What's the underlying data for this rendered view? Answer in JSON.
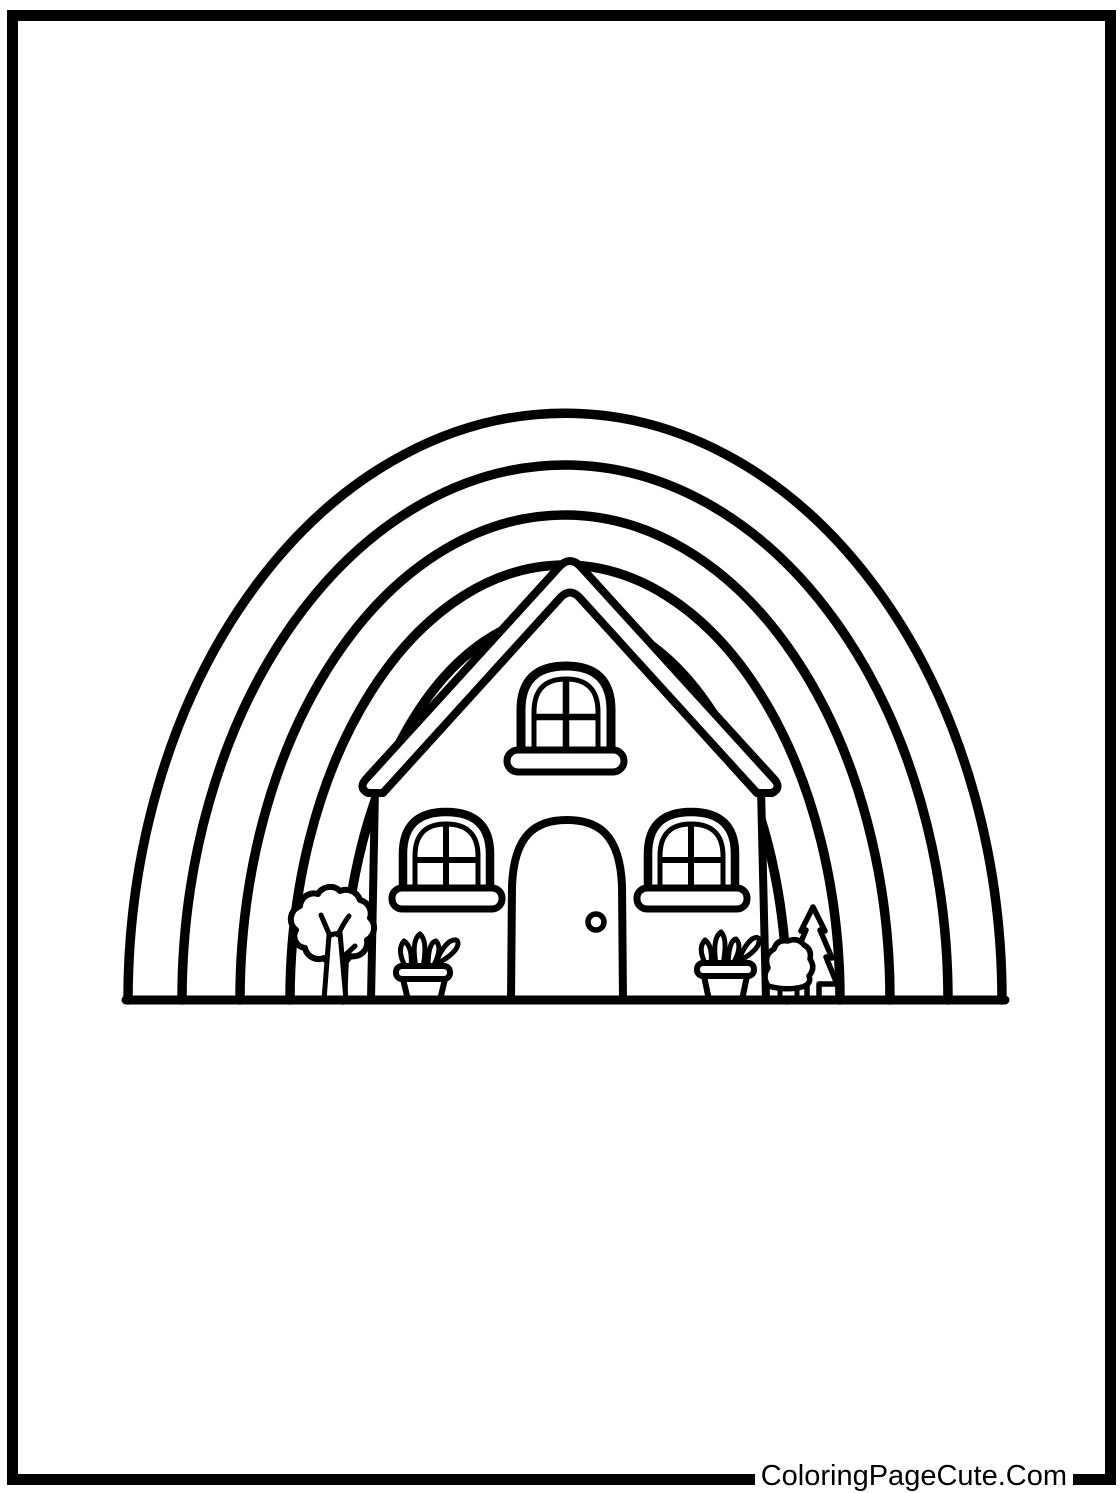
{
  "watermark": {
    "text": "ColoringPageCute.Com"
  },
  "colors": {
    "ink": "#000000",
    "paper": "#ffffff"
  },
  "scene": {
    "description": "Black-and-white coloring page: a house with an arched attic window, two arched front windows, an arched door with doorknob, under a five-arc rainbow; a round tree, two flower pots with sprouts, a bush and a pine tree stand on a ground line; thick black rectangular page border.",
    "rainbow_arcs": 5,
    "objects": [
      "rainbow",
      "house",
      "roof",
      "attic-window",
      "left-window",
      "right-window",
      "door",
      "doorknob",
      "tree",
      "flower-pot-left",
      "flower-pot-right",
      "bush",
      "pine-tree",
      "ground-line",
      "page-border",
      "watermark"
    ]
  }
}
